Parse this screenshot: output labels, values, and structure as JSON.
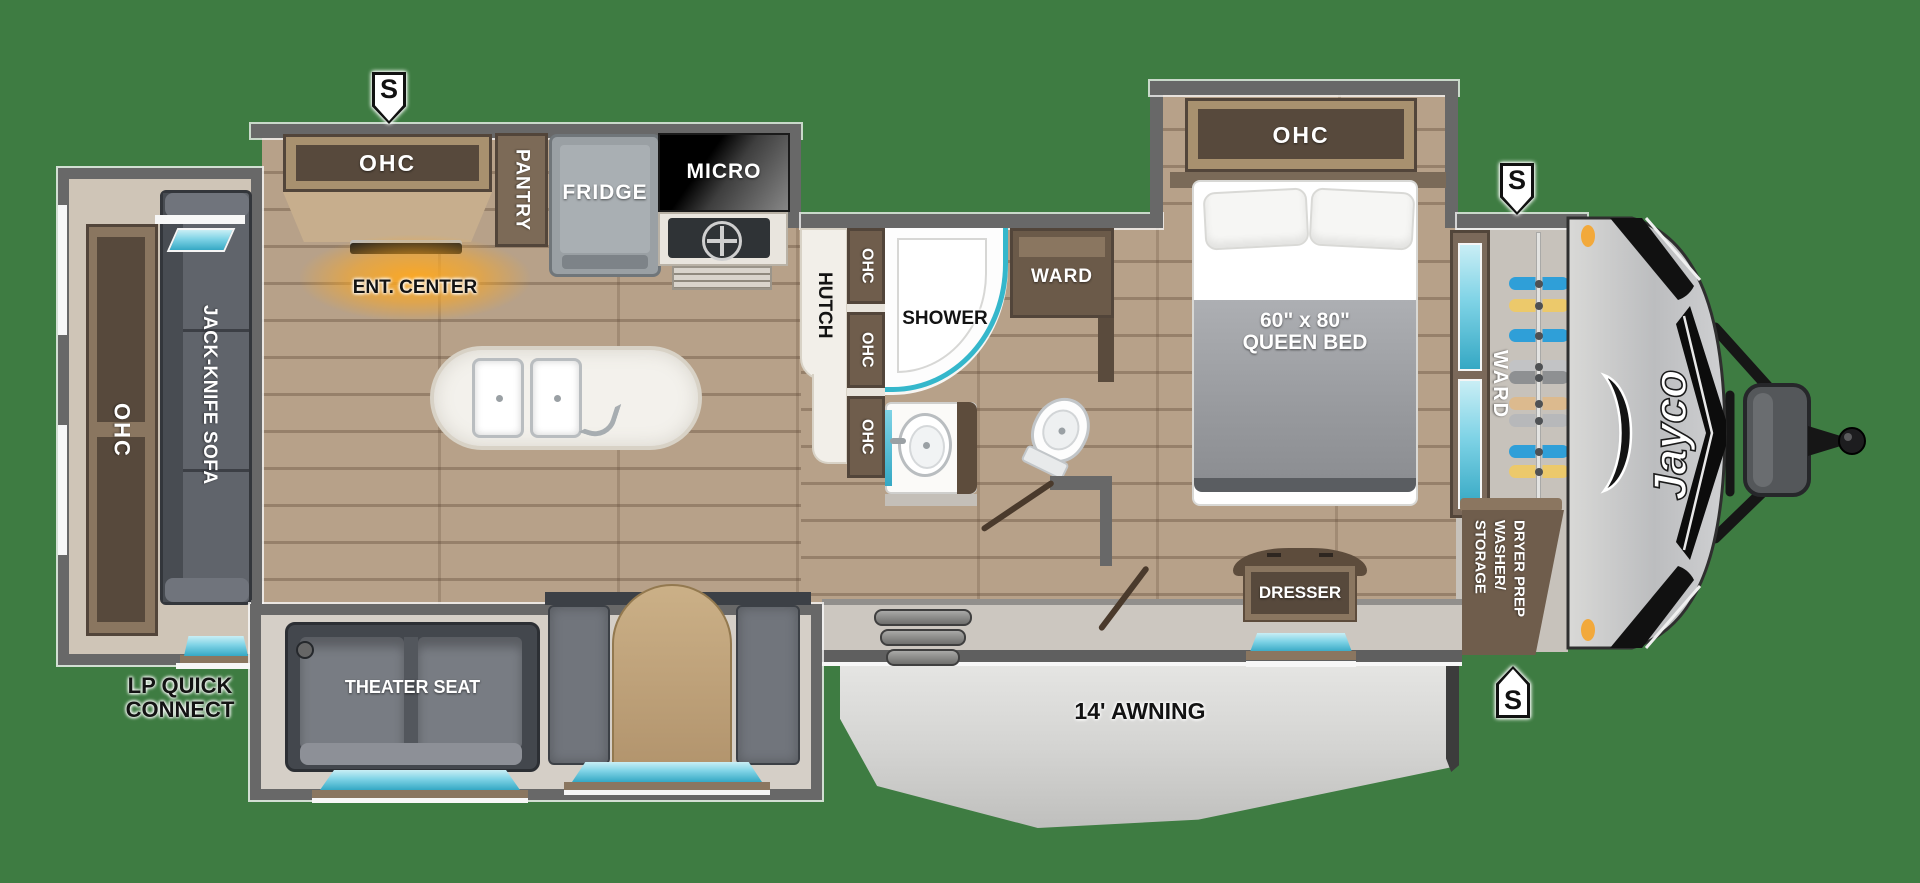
{
  "colors": {
    "background": "#3e7c42",
    "wall_gray": "#686868",
    "accent_teal": "#35a8c4",
    "wood_floor": "#b7a189",
    "cabinet_brown": "#7b695a",
    "amber_light": "#f2a93b"
  },
  "speaker": {
    "label": "S"
  },
  "rear": {
    "ohc": "OHC",
    "sofa": "JACK-KNIFE SOFA",
    "lp_line1": "LP QUICK",
    "lp_line2": "CONNECT"
  },
  "kitchen": {
    "ohc": "OHC",
    "ent": "ENT. CENTER",
    "pantry": "PANTRY",
    "fridge": "FRIDGE",
    "micro": "MICRO"
  },
  "galley": {
    "hutch": "HUTCH",
    "ohc1": "OHC",
    "ohc2": "OHC",
    "ohc3": "OHC"
  },
  "bath": {
    "shower": "SHOWER",
    "ward": "WARD"
  },
  "bedroom": {
    "ohc": "OHC",
    "bed_size": "60\" x 80\"",
    "bed_type": "QUEEN BED",
    "dresser": "DRESSER"
  },
  "living": {
    "theater": "THEATER SEAT"
  },
  "front": {
    "ward": "WARD",
    "storage1": "STORAGE",
    "storage2": "WASHER/",
    "storage3": "DRYER PREP",
    "brand": "Jayco",
    "hangers": [
      {
        "y": 284,
        "color": "#2f9fd8"
      },
      {
        "y": 306,
        "color": "#ecc96b"
      },
      {
        "y": 336,
        "color": "#2f9fd8"
      },
      {
        "y": 367,
        "color": "#c2c3c5"
      },
      {
        "y": 378,
        "color": "#8e9092"
      },
      {
        "y": 404,
        "color": "#dcba8e"
      },
      {
        "y": 421,
        "color": "#b7b8ba"
      },
      {
        "y": 452,
        "color": "#2f9fd8"
      },
      {
        "y": 472,
        "color": "#ecc96b"
      }
    ]
  },
  "exterior": {
    "awning": "14' AWNING"
  }
}
